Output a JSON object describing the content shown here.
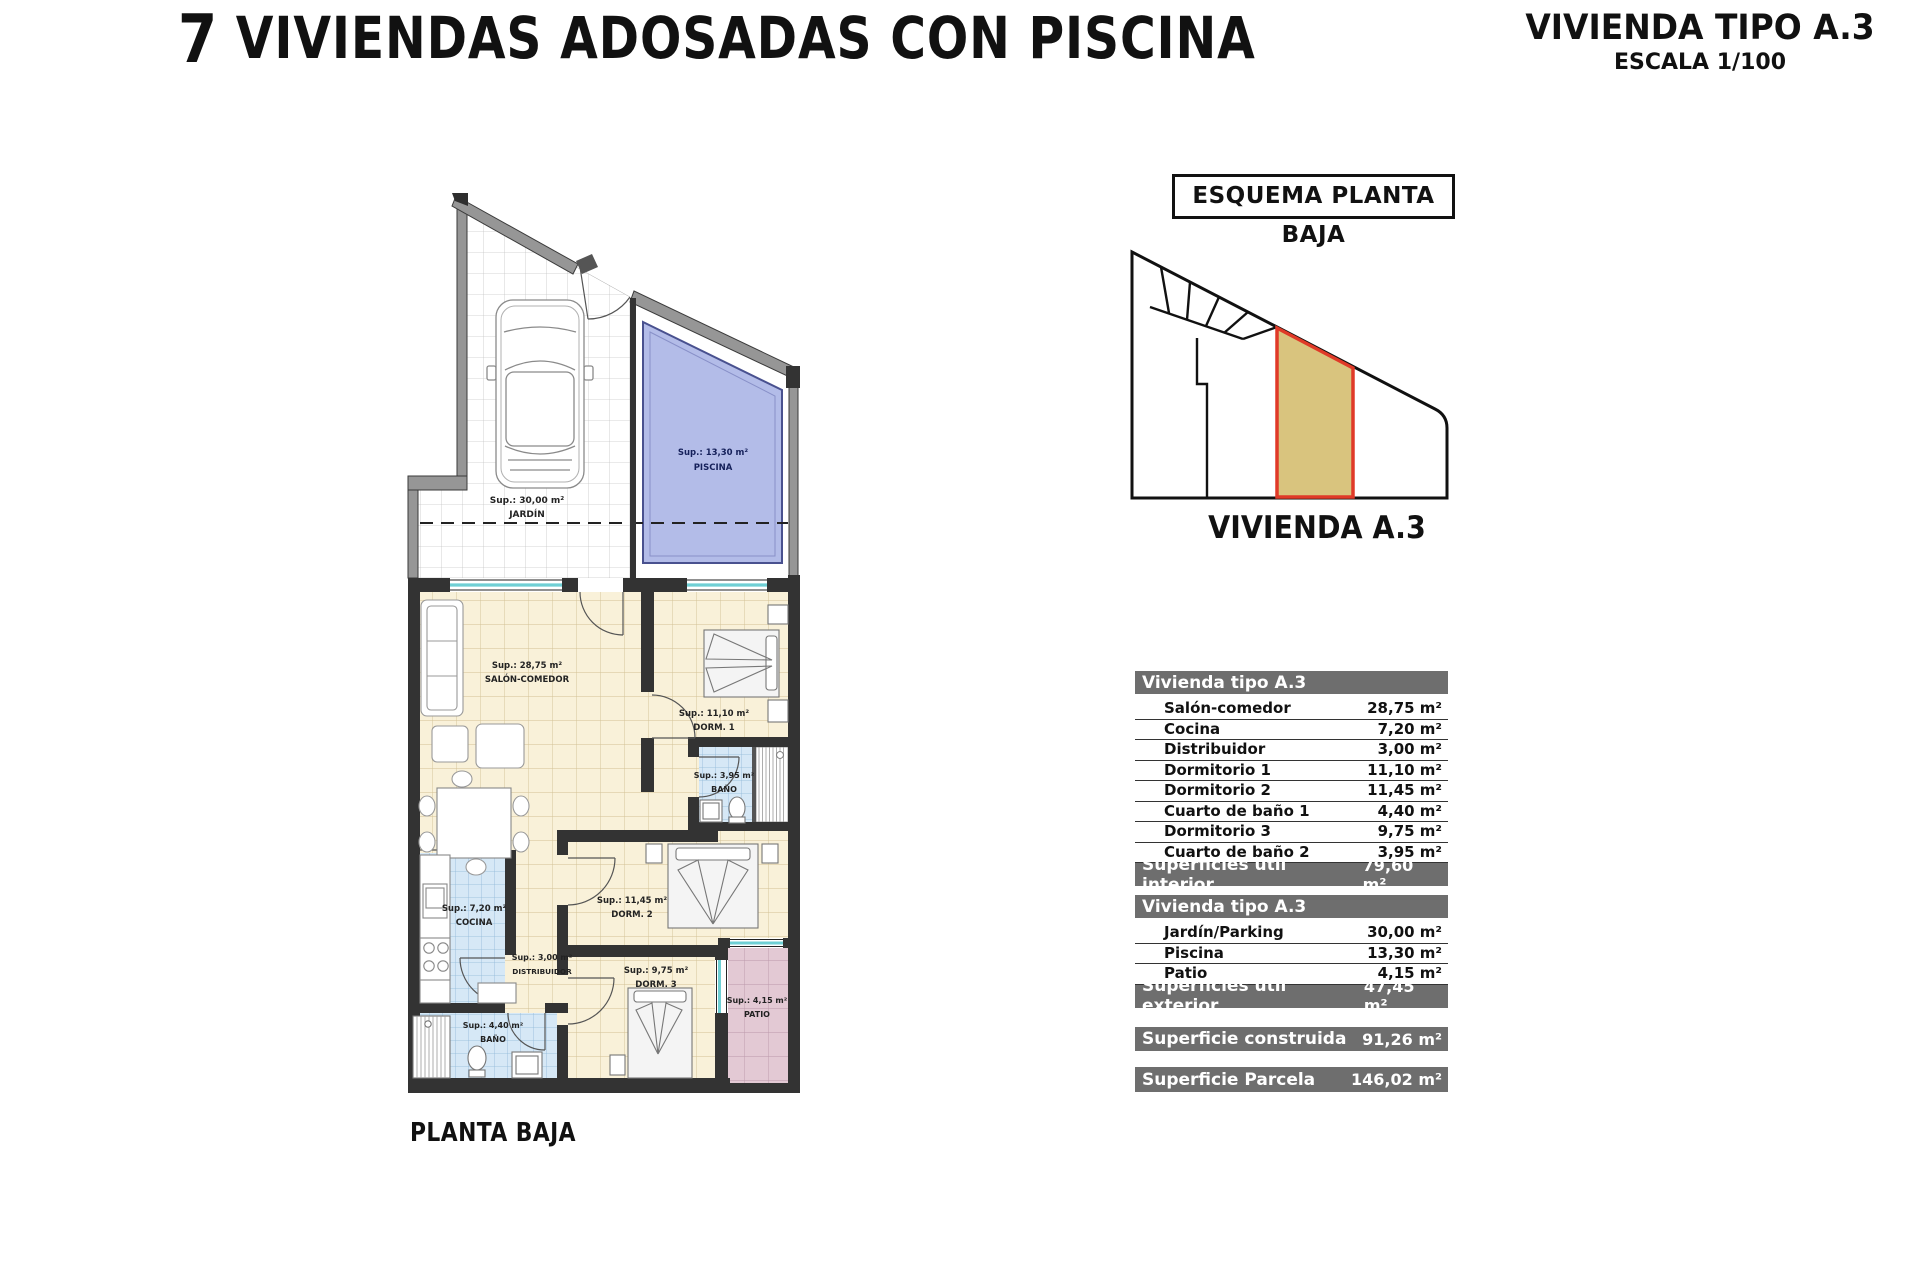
{
  "header": {
    "title_number": "7",
    "title_text": " VIVIENDAS ADOSADAS CON PISCINA",
    "subtitle": "VIVIENDA TIPO A.3",
    "scale": "ESCALA 1/100"
  },
  "esquema": {
    "box_label": "ESQUEMA PLANTA BAJA",
    "caption": "VIVIENDA A.3"
  },
  "plan": {
    "caption": "PLANTA BAJA",
    "rooms": {
      "jardin": {
        "sup": "Sup.: 30,00 m²",
        "name": "JARDÍN"
      },
      "piscina": {
        "sup": "Sup.: 13,30 m²",
        "name": "PISCINA"
      },
      "salon": {
        "sup": "Sup.: 28,75 m²",
        "name": "SALÓN-COMEDOR"
      },
      "dorm1": {
        "sup": "Sup.: 11,10 m²",
        "name": "DORM. 1"
      },
      "bano1": {
        "sup": "Sup.: 3,95 m²",
        "name": "BAÑO"
      },
      "cocina": {
        "sup": "Sup.: 7,20 m²",
        "name": "COCINA"
      },
      "distribuidor": {
        "sup": "Sup.: 3,00 m²",
        "name": "DISTRIBUIDOR"
      },
      "dorm2": {
        "sup": "Sup.: 11,45 m²",
        "name": "DORM. 2"
      },
      "dorm3": {
        "sup": "Sup.: 9,75 m²",
        "name": "DORM. 3"
      },
      "bano2": {
        "sup": "Sup.: 4,40 m²",
        "name": "BAÑO"
      },
      "patio": {
        "sup": "Sup.: 4,15 m²",
        "name": "PATIO"
      }
    }
  },
  "tables": {
    "interior": {
      "header": "Vivienda tipo A.3",
      "rows": [
        {
          "label": "Salón-comedor",
          "value": "28,75 m²"
        },
        {
          "label": "Cocina",
          "value": "7,20 m²"
        },
        {
          "label": "Distribuidor",
          "value": "3,00 m²"
        },
        {
          "label": "Dormitorio 1",
          "value": "11,10 m²"
        },
        {
          "label": "Dormitorio 2",
          "value": "11,45 m²"
        },
        {
          "label": "Cuarto de baño 1",
          "value": "4,40 m²"
        },
        {
          "label": "Dormitorio 3",
          "value": "9,75 m²"
        },
        {
          "label": "Cuarto de baño 2",
          "value": "3,95 m²"
        }
      ],
      "footer_label": "Superficies útil interior",
      "footer_value": "79,60 m²"
    },
    "exterior": {
      "header": "Vivienda tipo A.3",
      "rows": [
        {
          "label": "Jardín/Parking",
          "value": "30,00 m²"
        },
        {
          "label": "Piscina",
          "value": "13,30 m²"
        },
        {
          "label": "Patio",
          "value": "4,15 m²"
        }
      ],
      "footer_label": "Superficies útil exterior",
      "footer_value": "47,45 m²"
    },
    "construida": {
      "label": "Superficie construida",
      "value": "91,26 m²"
    },
    "parcela": {
      "label": "Superficie Parcela",
      "value": "146,02 m²"
    }
  },
  "colors": {
    "bar_gray": "#6e6e6e",
    "wall_dark": "#333333",
    "wall_gray": "#969696",
    "window_cyan": "#6ecfd4",
    "pool_blue": "#b3bce8",
    "floor_cream": "#f9f1d9",
    "floor_wet_blue": "#d6e8f6",
    "patio_pink": "#e3c9d4",
    "parcel_tan": "#d9c47e",
    "parcel_red": "#e03a28"
  }
}
